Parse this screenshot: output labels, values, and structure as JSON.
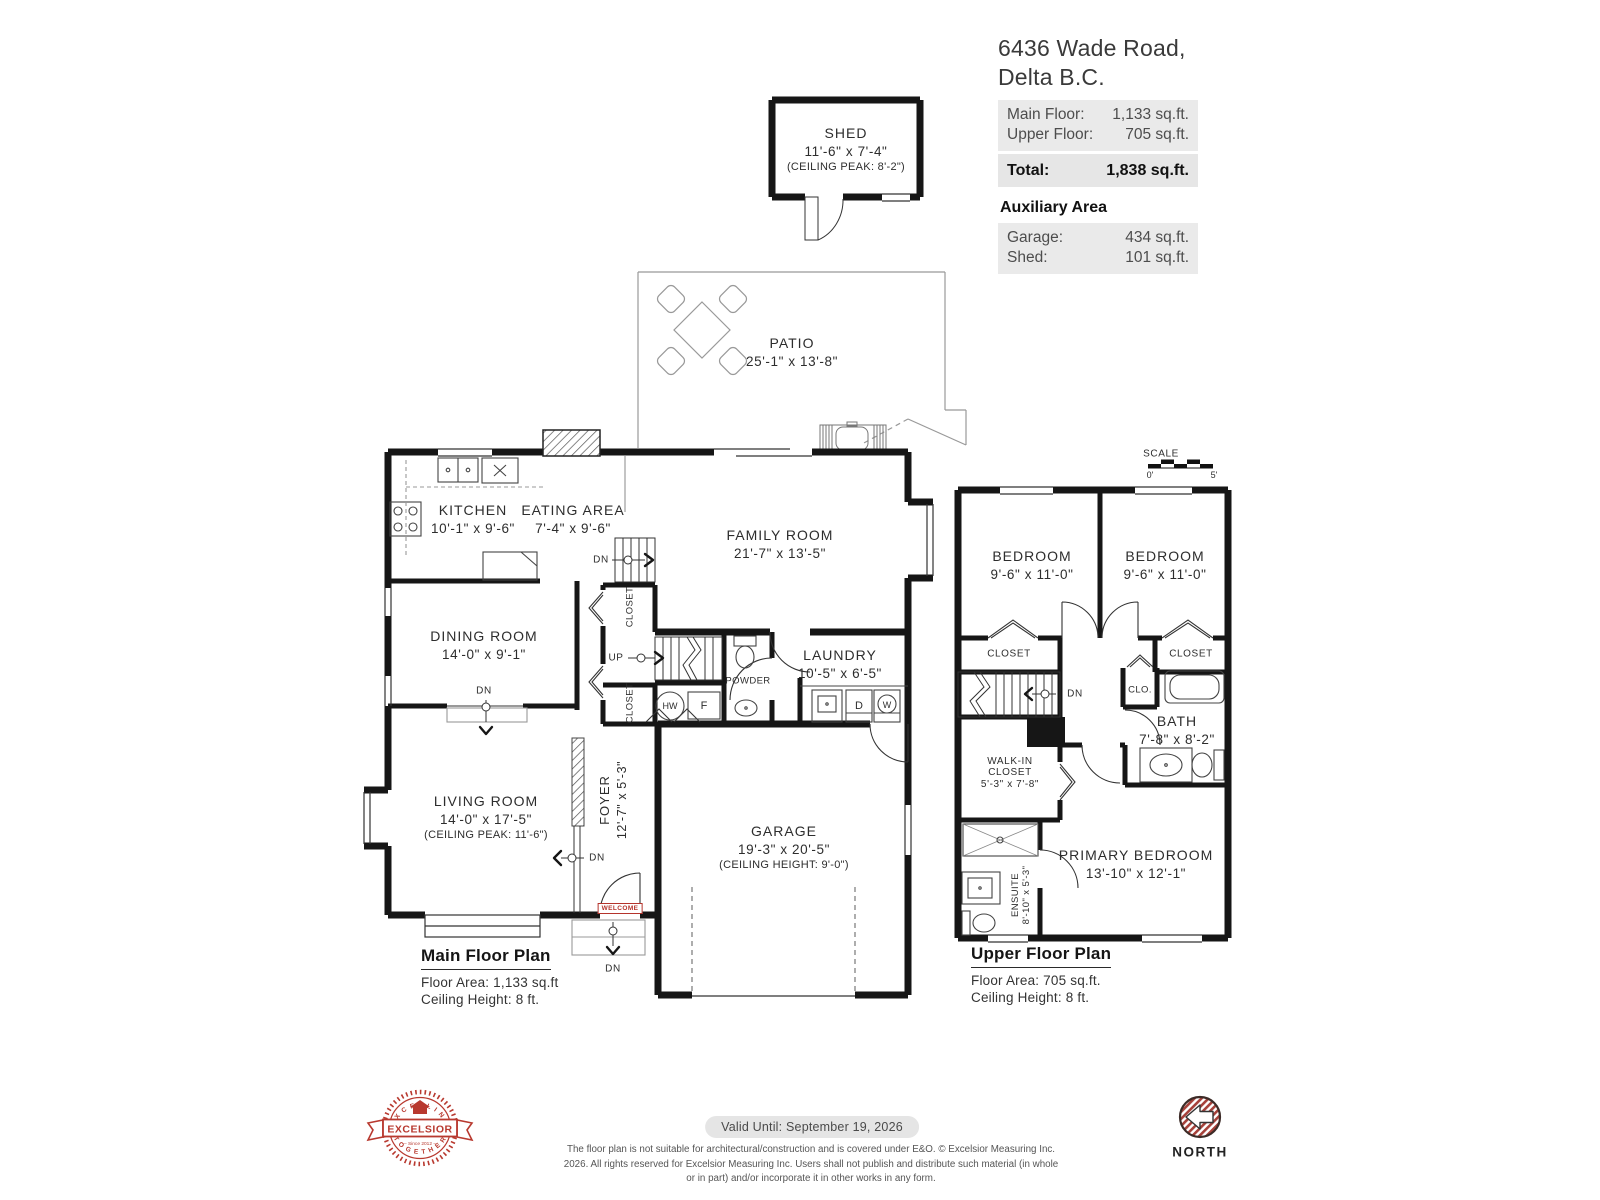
{
  "header": {
    "address_line1": "6436 Wade Road,",
    "address_line2": "Delta B.C.",
    "areas": [
      {
        "label": "Main Floor:",
        "value": "1,133 sq.ft."
      },
      {
        "label": "Upper Floor:",
        "value": "705 sq.ft."
      }
    ],
    "total": {
      "label": "Total:",
      "value": "1,838 sq.ft."
    },
    "auxiliary_title": "Auxiliary Area",
    "auxiliary": [
      {
        "label": "Garage:",
        "value": "434 sq.ft."
      },
      {
        "label": "Shed:",
        "value": "101 sq.ft."
      }
    ]
  },
  "shed": {
    "name": "SHED",
    "dims": "11'-6\" x 7'-4\"",
    "note": "(CEILING PEAK: 8'-2\")"
  },
  "patio": {
    "name": "PATIO",
    "dims": "25'-1\" x 13'-8\""
  },
  "main_floor": {
    "kitchen": {
      "name": "KITCHEN",
      "dims": "10'-1\" x 9'-6\""
    },
    "eating": {
      "name": "EATING AREA",
      "dims": "7'-4\" x 9'-6\""
    },
    "family": {
      "name": "FAMILY ROOM",
      "dims": "21'-7\" x 13'-5\""
    },
    "dining": {
      "name": "DINING ROOM",
      "dims": "14'-0\" x 9'-1\""
    },
    "living": {
      "name": "LIVING ROOM",
      "dims": "14'-0\" x 17'-5\"",
      "note": "(CEILING PEAK: 11'-6\")"
    },
    "foyer": {
      "name": "FOYER",
      "dims": "12'-7\" x 5'-3\""
    },
    "laundry": {
      "name": "LAUNDRY",
      "dims": "10'-5\" x 6'-5\""
    },
    "powder": {
      "name": "POWDER"
    },
    "garage": {
      "name": "GARAGE",
      "dims": "19'-3\" x 20'-5\"",
      "note": "(CEILING HEIGHT: 9'-0\")"
    },
    "closet_upper": "CLOSET",
    "closet_lower": "CLOSET",
    "hw": "HW",
    "f": "F",
    "d": "D",
    "w": "W",
    "up": "UP",
    "dn": "DN",
    "welcome": "WELCOME",
    "plan_title": "Main Floor Plan",
    "floor_area": "Floor Area: 1,133 sq.ft",
    "ceiling": "Ceiling Height: 8 ft."
  },
  "upper_floor": {
    "scale": {
      "label": "SCALE",
      "start": "0'",
      "end": "5'"
    },
    "bedroom_left": {
      "name": "BEDROOM",
      "dims": "9'-6\" x 11'-0\""
    },
    "bedroom_right": {
      "name": "BEDROOM",
      "dims": "9'-6\" x 11'-0\""
    },
    "closet_left": "CLOSET",
    "closet_right": "CLOSET",
    "clo": "CLO.",
    "bath": {
      "name": "BATH",
      "dims": "7'-8\" x 8'-2\""
    },
    "walkin": {
      "line1": "WALK-IN",
      "line2": "CLOSET",
      "dims": "5'-3\" x 7'-8\""
    },
    "ensuite": {
      "name": "ENSUITE",
      "dims": "8'-10\" x 5'-3\""
    },
    "primary": {
      "name": "PRIMARY BEDROOM",
      "dims": "13'-10\" x 12'-1\""
    },
    "dn": "DN",
    "plan_title": "Upper Floor Plan",
    "floor_area": "Floor Area: 705 sq.ft.",
    "ceiling": "Ceiling Height: 8 ft."
  },
  "footer": {
    "valid_until": "Valid Until: September 19, 2026",
    "disclaimer": "The floor plan is not suitable for architectural/construction and is covered under E&O. © Excelsior Measuring Inc. 2026. All rights reserved for Excelsior Measuring Inc. Users shall not publish and distribute such material (in whole or in part) and/or incorporate it in other works in any form.",
    "north_label": "NORTH",
    "logo": {
      "top": "· E X C E L L I N G ·",
      "middle": "EXCELSIOR",
      "bottom": "· T O G E T H E R ·",
      "since": "— Since 2012 —"
    }
  },
  "colors": {
    "accent_red": "#b8392f",
    "wall": "#161616",
    "panel_gray": "#eaeaea"
  }
}
